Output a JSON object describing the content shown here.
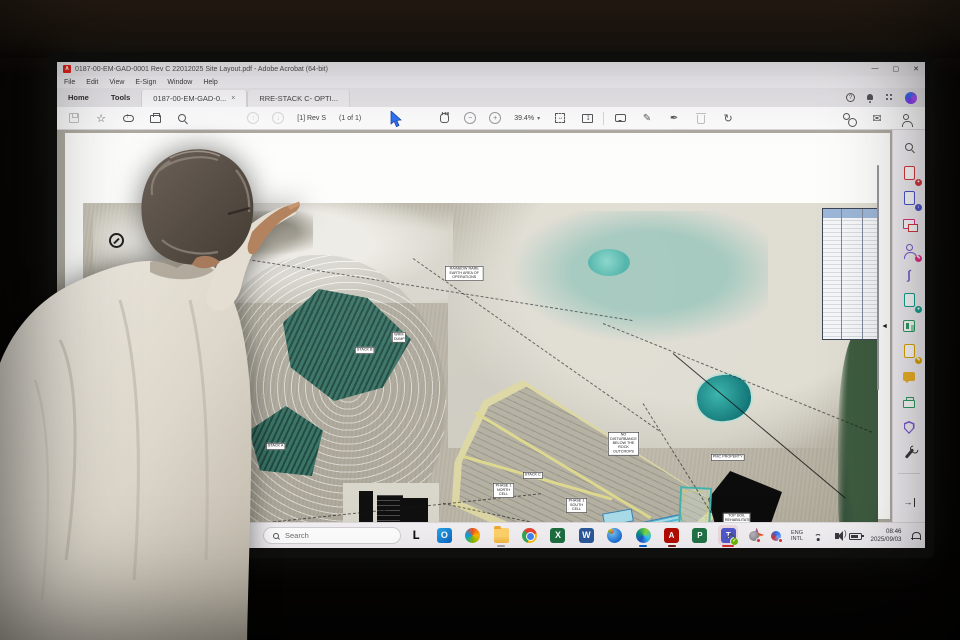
{
  "window": {
    "app_title": "0187-00-EM-GAD-0001 Rev C 22012025 Site Layout.pdf - Adobe Acrobat (64-bit)",
    "menu_items": [
      "File",
      "Edit",
      "View",
      "E-Sign",
      "Window",
      "Help"
    ],
    "minimize": "—",
    "maximize": "▢",
    "close": "✕"
  },
  "tabs": {
    "home": "Home",
    "tools": "Tools",
    "doc1": "0187-00-EM-GAD-0...",
    "doc1_close": "×",
    "doc2": "RRE-STACK C- OPTI..."
  },
  "toolbar": {
    "page_indicator": "[1] Rev S",
    "page_count": "(1 of 1)",
    "zoom_value": "39.4%",
    "zoom_caret": "▾",
    "nav_up": "↑",
    "nav_down": "↓",
    "zoom_out": "−",
    "zoom_in": "+",
    "pencil_glyph": "✎",
    "sign_glyph": "✒",
    "rotate_glyph": "↻",
    "mail_glyph": "✉",
    "star_glyph": "☆",
    "help_glyph": "?"
  },
  "right_tools": [
    "search",
    "create-pdf",
    "export-pdf",
    "organize-pages",
    "request-e-signatures",
    "fill-and-sign",
    "compress-pdf",
    "combine-files",
    "edit-pdf",
    "comment",
    "print-production",
    "protect",
    "more-tools"
  ],
  "panel": {
    "collapse_glyph": "◄",
    "expander_glyph": "→"
  },
  "taskbar": {
    "search_placeholder": "Search",
    "apps": [
      "l-launcher",
      "outlook",
      "copilot",
      "file-explorer",
      "chrome",
      "excel",
      "word",
      "globe",
      "edge",
      "acrobat",
      "project",
      "teams",
      "photos"
    ],
    "app_letters": {
      "l": "L",
      "excel": "X",
      "word": "W",
      "acrobat": "A",
      "project": "P",
      "teams": "T"
    },
    "tray": {
      "language_line1": "ENG",
      "language_line2": "INTL",
      "time": "08:46",
      "date": "2025/09/03"
    }
  },
  "map": {
    "labels": [
      {
        "text": "RAINBOW RARE EARTH AREA OF OPERATIONS"
      },
      {
        "text": "STACK B"
      },
      {
        "text": "STACK A"
      },
      {
        "text": "STACK C"
      },
      {
        "text": "PHASE 1 NORTH CELL"
      },
      {
        "text": "PHASE 1 SOUTH CELL"
      },
      {
        "text": "PMC PROPERTY"
      },
      {
        "text": "TOP SOIL REHABILITATION STACK - MAX 3.5m"
      },
      {
        "text": "PROCESS PLANT"
      },
      {
        "text": "NO DISTURBANCE BELOW THE ROCK OUTCROPS"
      },
      {
        "text": "POWER LINE SERVITUDE"
      },
      {
        "text": "WRM DUMP"
      }
    ]
  },
  "colors": {
    "accent_blue": "#2f6fed",
    "acrobat_red": "#e2231a",
    "teams_purple": "#5059c9",
    "taskbar_active_underline": "#d13438",
    "stack_green": "#2d6a5c",
    "pond_teal": "#127678"
  }
}
